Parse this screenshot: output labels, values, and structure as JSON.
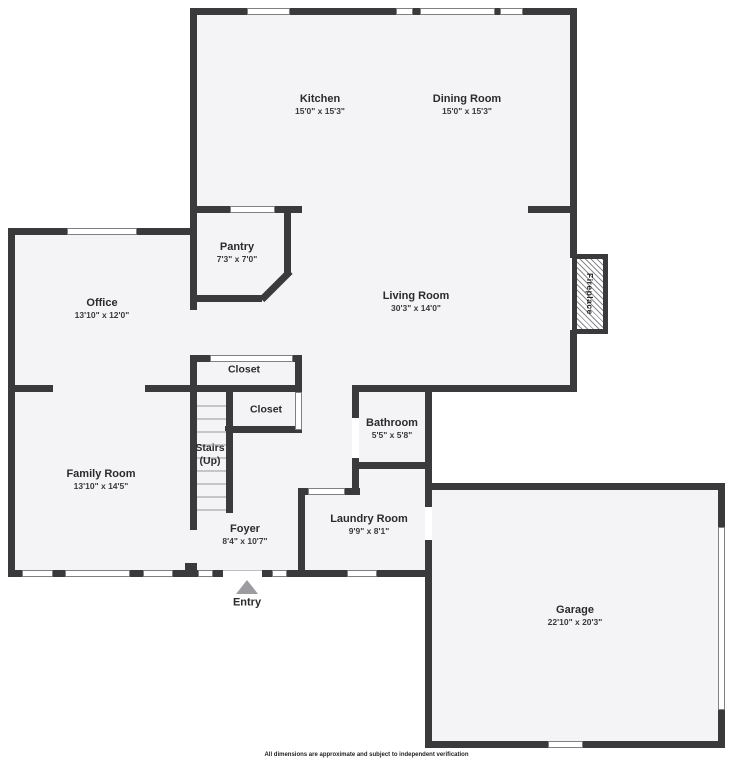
{
  "floorplan": {
    "rooms": {
      "kitchen": {
        "name": "Kitchen",
        "dims": "15'0\" x 15'3\""
      },
      "dining": {
        "name": "Dining Room",
        "dims": "15'0\" x 15'3\""
      },
      "pantry": {
        "name": "Pantry",
        "dims": "7'3\" x 7'0\""
      },
      "living": {
        "name": "Living Room",
        "dims": "30'3\" x 14'0\""
      },
      "office": {
        "name": "Office",
        "dims": "13'10\" x 12'0\""
      },
      "family": {
        "name": "Family Room",
        "dims": "13'10\" x 14'5\""
      },
      "bathroom": {
        "name": "Bathroom",
        "dims": "5'5\" x 5'8\""
      },
      "laundry": {
        "name": "Laundry Room",
        "dims": "9'9\" x 8'1\""
      },
      "foyer": {
        "name": "Foyer",
        "dims": "8'4\" x 10'7\""
      },
      "garage": {
        "name": "Garage",
        "dims": "22'10\" x 20'3\""
      },
      "closet_upper": {
        "name": "Closet"
      },
      "closet_lower": {
        "name": "Closet"
      },
      "stairs": {
        "name": "Stairs",
        "sub": "(Up)"
      }
    },
    "features": {
      "fireplace_label": "Fireplace",
      "entry_label": "Entry"
    },
    "footer_disclaimer": "All dimensions are approximate and subject to independent verification",
    "colors": {
      "wall": "#3a3a3c",
      "floor": "#f4f4f6",
      "entry_arrow": "#9c9ca0"
    }
  }
}
